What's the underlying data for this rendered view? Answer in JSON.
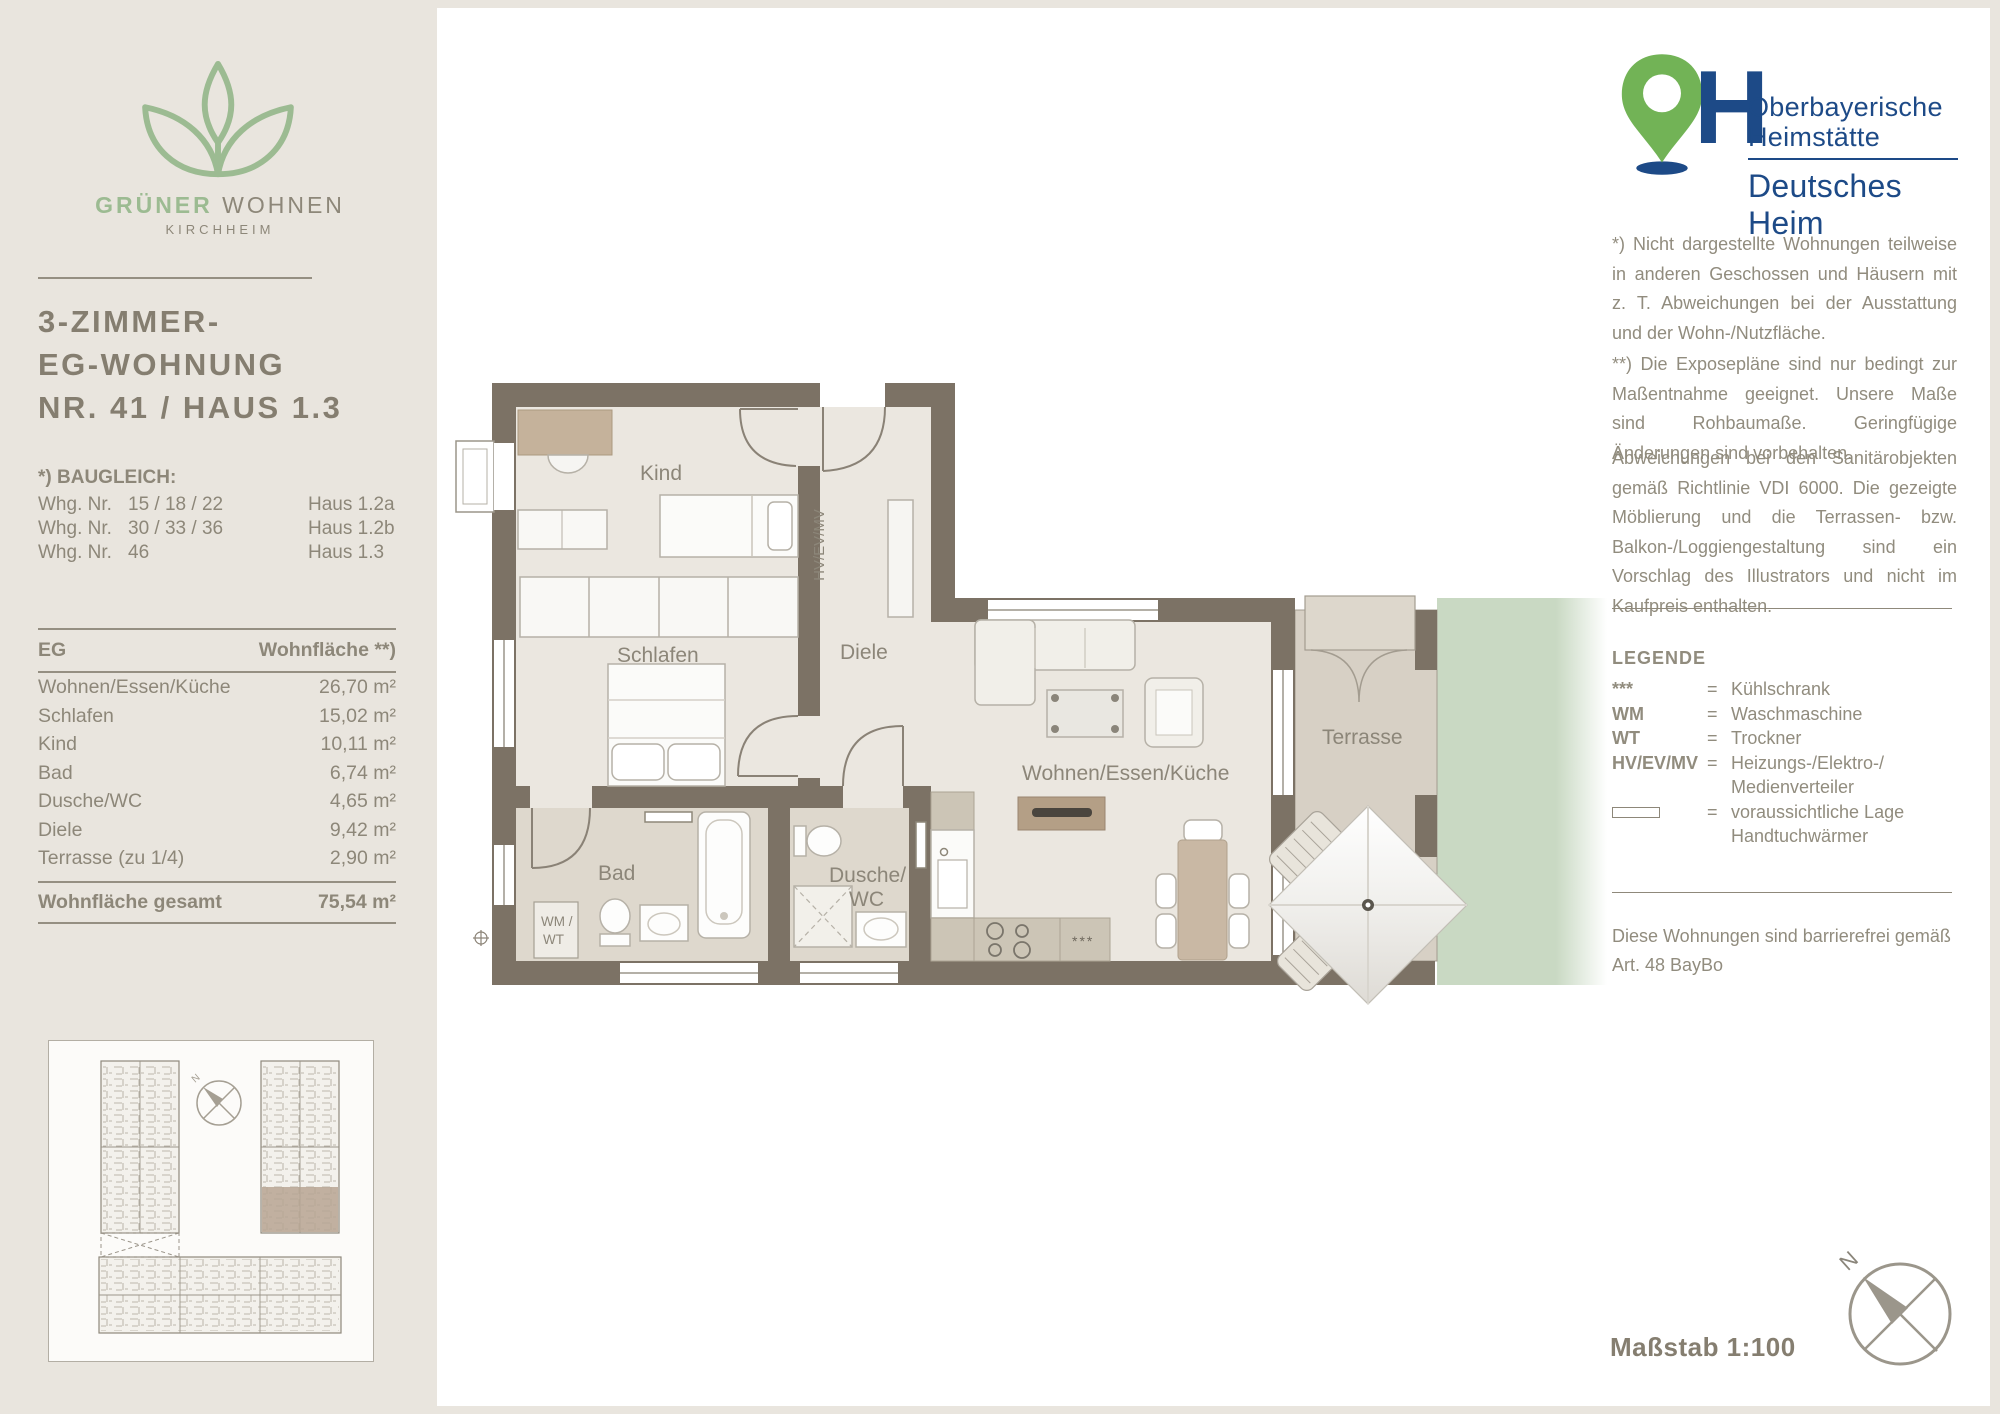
{
  "brand": {
    "name_bold": "GRÜNER",
    "name_regular": "WOHNEN",
    "location": "KIRCHHEIM"
  },
  "title": {
    "line1": "3-ZIMMER-",
    "line2": "EG-WOHNUNG",
    "line3": "NR. 41 / HAUS 1.3"
  },
  "baugleich": {
    "heading": "*) BAUGLEICH:",
    "rows": [
      {
        "label": "Whg. Nr.",
        "numbers": "15 / 18 / 22",
        "haus": "Haus 1.2a"
      },
      {
        "label": "Whg. Nr.",
        "numbers": "30 / 33 / 36",
        "haus": "Haus 1.2b"
      },
      {
        "label": "Whg. Nr.",
        "numbers": "46",
        "haus": "Haus 1.3"
      }
    ]
  },
  "area_table": {
    "col1": "EG",
    "col2": "Wohnfläche **)",
    "rows": [
      {
        "room": "Wohnen/Essen/Küche",
        "area": "26,70 m²"
      },
      {
        "room": "Schlafen",
        "area": "15,02 m²"
      },
      {
        "room": "Kind",
        "area": "10,11 m²"
      },
      {
        "room": "Bad",
        "area": "6,74 m²"
      },
      {
        "room": "Dusche/WC",
        "area": "4,65 m²"
      },
      {
        "room": "Diele",
        "area": "9,42 m²"
      },
      {
        "room": "Terrasse (zu 1/4)",
        "area": "2,90 m²"
      }
    ],
    "total_label": "Wohnfläche gesamt",
    "total_value": "75,54 m²"
  },
  "floorplan": {
    "labels": {
      "kind": "Kind",
      "schlafen": "Schlafen",
      "diele": "Diele",
      "bad": "Bad",
      "dusche_line1": "Dusche/",
      "dusche_line2": "WC",
      "wohnen": "Wohnen/Essen/Küche",
      "terrasse": "Terrasse",
      "hv": "HV/EV/MV",
      "wm_line1": "WM /",
      "wm_line2": "WT",
      "fridge": "***"
    }
  },
  "publisher": {
    "line1": "Oberbayerische",
    "line2": "Heimstätte",
    "line3": "Deutsches Heim",
    "letter": "H"
  },
  "notes": {
    "p1": "*) Nicht dargestellte Wohnungen teilweise in anderen Geschossen und Häusern mit z. T. Abweichungen bei der Ausstattung und der Wohn-/Nutzfläche.",
    "p2": "**) Die Exposepläne sind nur bedingt zur Maßentnahme geeignet. Unsere Maße sind Rohbaumaße. Geringfügige Änderungen sind vorbehalten.",
    "p3": "Abweichungen bei den Sanitärobjekten gemäß Richtlinie VDI 6000. Die gezeigte Möblierung und die Terrassen- bzw. Balkon-/Loggiengestaltung sind ein Vorschlag des Illustrators und nicht im Kaufpreis enthalten."
  },
  "legend": {
    "heading": "LEGENDE",
    "items": [
      {
        "symbol": "***",
        "text": "Kühlschrank"
      },
      {
        "symbol": "WM",
        "text": "Waschmaschine"
      },
      {
        "symbol": "WT",
        "text": "Trockner"
      },
      {
        "symbol": "HV/EV/MV",
        "text": "Heizungs-/Elektro-/ Medienverteiler"
      },
      {
        "symbol_icon": "rect-outline",
        "symbol": "",
        "text": "voraussichtliche Lage Handtuchwärmer"
      }
    ]
  },
  "barrier_free": "Diese Wohnungen sind barrierefrei gemäß Art. 48 BayBo",
  "scale_label": "Maßstab 1:100",
  "compass": {
    "north": "N"
  },
  "colors": {
    "background": "#e9e5de",
    "card": "#ffffff",
    "wall": "#7c7265",
    "floor": "#ebe7e0",
    "bath_floor": "#ded8cd",
    "terrace_floor": "#d7d0c5",
    "garden_green": "#c9d9c3",
    "brand_green": "#9cbb92",
    "text_gray": "#8d8779",
    "oh_blue": "#1d4a87",
    "oh_green": "#72b356"
  }
}
